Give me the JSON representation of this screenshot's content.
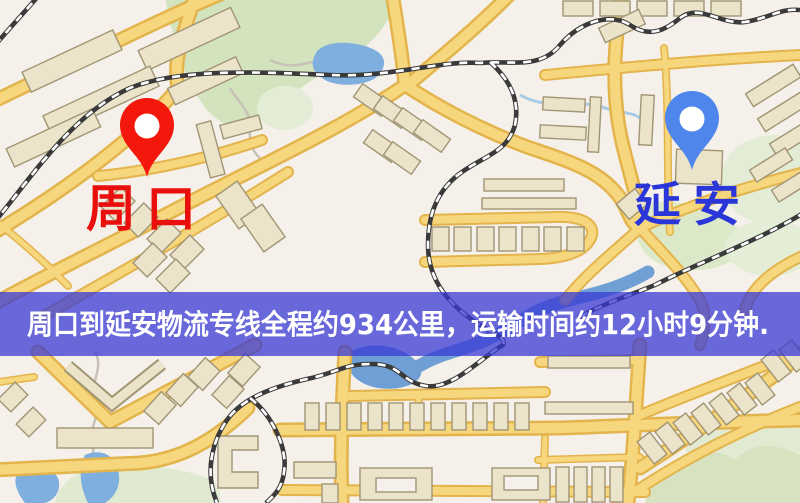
{
  "map": {
    "origin": {
      "name": "周口",
      "marker": "red-pin",
      "marker_color": "#f3170c",
      "label_color": "#e80f0c"
    },
    "destination": {
      "name": "延安",
      "marker": "blue-pin",
      "marker_color": "#4f86ec",
      "label_color": "#2a36d8"
    }
  },
  "banner": {
    "text": "周口到延安物流专线全程约934公里，运输时间约12小时9分钟.",
    "distance_text": "约934公里",
    "duration_text": "约12小时9分钟",
    "background_color": "#3a3ad6",
    "text_color": "#ffffff"
  },
  "palette": {
    "background": "#f5f1ea",
    "road_fill": "#f7d77e",
    "road_edge": "#e3b44c",
    "building_fill": "#ebe3ca",
    "building_edge": "#a19574",
    "greenery": "#d2e3bd",
    "greenery_pale": "#e3edd5",
    "water": "#7fafdf",
    "railway": "#3a3a3a"
  }
}
